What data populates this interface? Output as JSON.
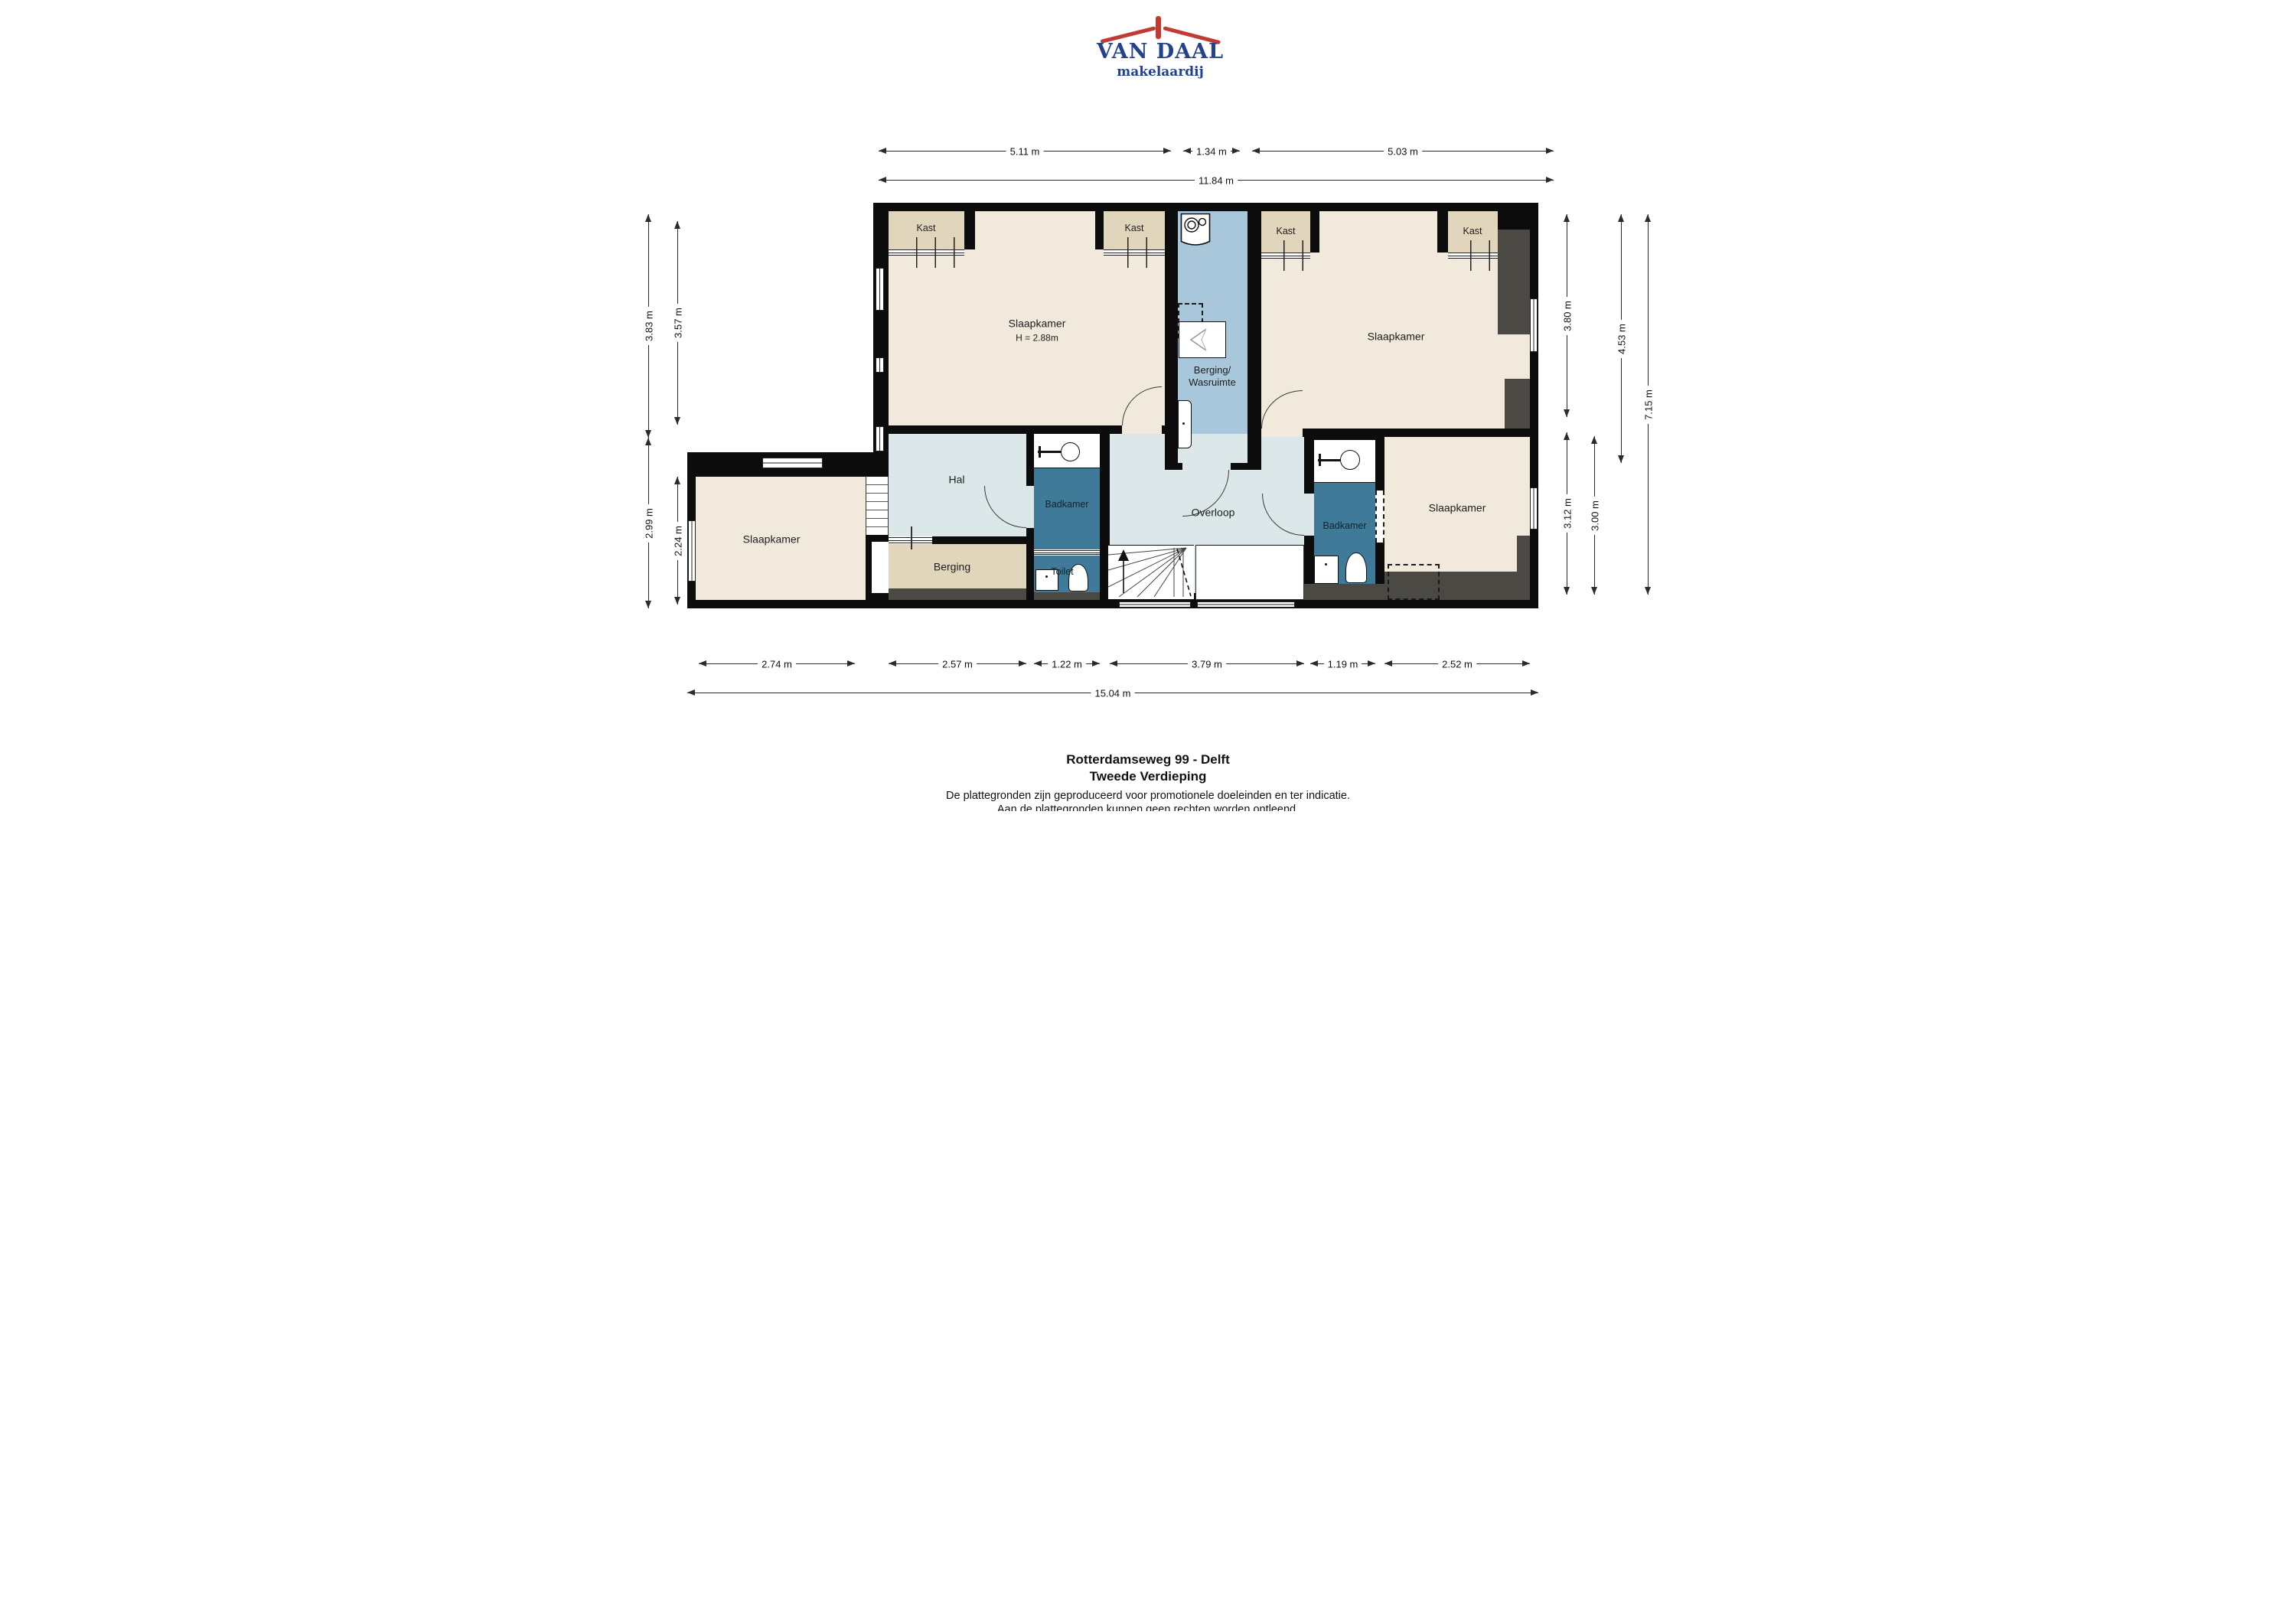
{
  "logo": {
    "name": "VAN DAAL",
    "tagline": "makelaardij"
  },
  "dimensions": {
    "top": [
      "5.11 m",
      "1.34 m",
      "5.03 m"
    ],
    "top_total": "11.84 m",
    "bottom": [
      "2.74 m",
      "2.57 m",
      "1.22 m",
      "3.79 m",
      "1.19 m",
      "2.52 m"
    ],
    "bottom_total": "15.04 m",
    "left": [
      "3.83 m",
      "3.57 m",
      "2.99 m",
      "2.24 m"
    ],
    "right": [
      "3.80 m",
      "3.12 m",
      "3.00 m",
      "4.53 m",
      "7.15 m"
    ]
  },
  "rooms": {
    "slaapkamer_top_left": {
      "label": "Slaapkamer",
      "ceiling_height": "H = 2.88m"
    },
    "slaapkamer_top_right": {
      "label": "Slaapkamer"
    },
    "slaapkamer_bottom_left": {
      "label": "Slaapkamer"
    },
    "slaapkamer_bottom_right": {
      "label": "Slaapkamer"
    },
    "berging_wasruimte": {
      "line1": "Berging/",
      "line2": "Wasruimte"
    },
    "hal": {
      "label": "Hal"
    },
    "badkamer_1": {
      "label": "Badkamer"
    },
    "badkamer_2": {
      "label": "Badkamer"
    },
    "toilet": {
      "label": "Toilet"
    },
    "berging": {
      "label": "Berging"
    },
    "overloop": {
      "label": "Overloop"
    },
    "kast_labels": [
      "Kast",
      "Kast",
      "Kast",
      "Kast"
    ]
  },
  "footer": {
    "address": "Rotterdamseweg 99 - Delft",
    "floor": "Tweede Verdieping",
    "disclaimer_line1": "De plattegronden zijn geproduceerd voor promotionele doeleinden en ter indicatie.",
    "disclaimer_line2": "Aan de plattegronden kunnen geen rechten worden ontleend."
  },
  "colors": {
    "wall": "#0c0c0c",
    "bedroom_fill": "#f1e9dc",
    "closet_fill": "#e1d6bc",
    "hall_fill": "#dce7e9",
    "laundry_fill": "#a9c7da",
    "bathroom_fill": "#3f7b98",
    "attic_gray": "#4b4943",
    "logo_red": "#c23b32",
    "logo_blue": "#24418c"
  }
}
